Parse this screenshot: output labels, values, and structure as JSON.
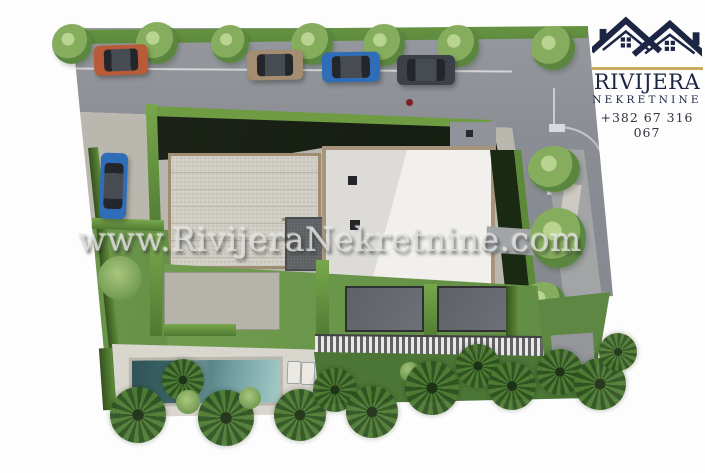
{
  "brand": {
    "name": "RIVIJERA",
    "subtitle": "NEKRETNINE",
    "phone": "+382 67 316 067",
    "logo_icon": "twin-house-roofs-icon",
    "colors": {
      "navy": "#1c2544",
      "gold": "#c8ab5e"
    }
  },
  "watermark": {
    "text": "www.RivijeraNekretnine.com"
  },
  "scene": {
    "description": "Top-down 3D architectural site plan of a villa plot with parking, main building, gravel terrace, lawns, swimming pool, pergola and palm garden",
    "colors": {
      "road": "#8a8d93",
      "paving": "#bab7af",
      "lawn": "#78a355",
      "hedge_bright": "#6f9c43",
      "hedge_dark": "#16250f",
      "building_roof": "#eceae5",
      "building_border": "#a6957c",
      "gravel": "#d2cfc7",
      "pool_dark": "#2f5356",
      "pool_light": "#a3cbc8",
      "deck": "#d9d6ce"
    },
    "cars": [
      {
        "position": "top-row-1",
        "color_name": "orange",
        "hex": "#b95a38"
      },
      {
        "position": "top-row-2",
        "color_name": "beige",
        "hex": "#a58d72"
      },
      {
        "position": "top-row-3",
        "color_name": "blue",
        "hex": "#2f6db8"
      },
      {
        "position": "top-row-4",
        "color_name": "dark-gray",
        "hex": "#3c4049"
      },
      {
        "position": "left-side",
        "color_name": "blue",
        "hex": "#2f6db8"
      }
    ],
    "tree_count_top_row": 7,
    "palm_count_bottom": 12
  }
}
